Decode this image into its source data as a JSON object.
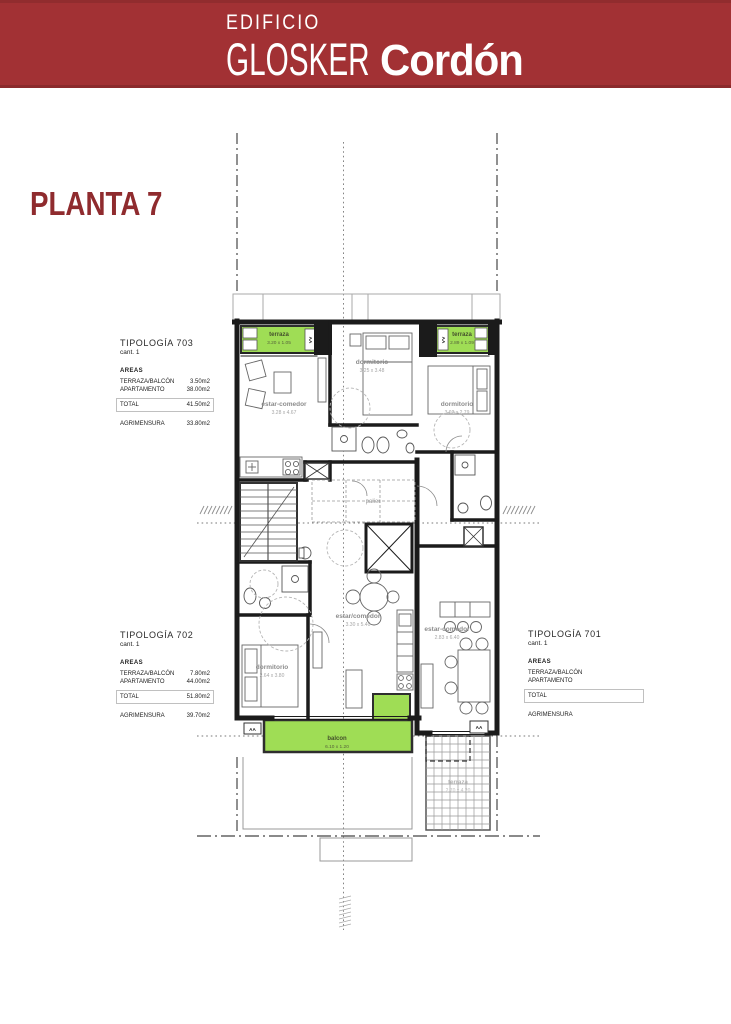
{
  "header": {
    "edificio": "EDIFICIO",
    "glosker": "GLOSKER",
    "cordon": "Cordón"
  },
  "page": {
    "title": "PLANTA 7"
  },
  "typologies": [
    {
      "title": "TIPOLOGÍA 703",
      "cant": "cant. 1",
      "areas_label": "AREAS",
      "rows": [
        {
          "label": "TERRAZA/BALCÓN",
          "value": "3.50m2"
        },
        {
          "label": "APARTAMENTO",
          "value": "38.00m2"
        }
      ],
      "total_label": "TOTAL",
      "total_value": "41.50m2",
      "agrimensura_label": "AGRIMENSURA",
      "agrimensura_value": "33.80m2"
    },
    {
      "title": "TIPOLOGÍA 702",
      "cant": "cant. 1",
      "areas_label": "AREAS",
      "rows": [
        {
          "label": "TERRAZA/BALCÓN",
          "value": "7.80m2"
        },
        {
          "label": "APARTAMENTO",
          "value": "44.00m2"
        }
      ],
      "total_label": "TOTAL",
      "total_value": "51.80m2",
      "agrimensura_label": "AGRIMENSURA",
      "agrimensura_value": "39.70m2"
    },
    {
      "title": "TIPOLOGÍA 701",
      "cant": "cant. 1",
      "areas_label": "AREAS",
      "rows": [
        {
          "label": "TERRAZA/BALCÓN",
          "value": ""
        },
        {
          "label": "APARTAMENTO",
          "value": ""
        }
      ],
      "total_label": "TOTAL",
      "total_value": "",
      "agrimensura_label": "AGRIMENSURA",
      "agrimensura_value": ""
    }
  ],
  "plan": {
    "rooms": {
      "terraza_703": {
        "name": "terraza",
        "dims": "3.20 x 1.05"
      },
      "dormitorio_703": {
        "name": "dormitorio",
        "dims": "3.25 x 3.48"
      },
      "terraza_701_top": {
        "name": "terraza",
        "dims": "2.89 x 1.09"
      },
      "estar_comedor_703": {
        "name": "estar-comedor",
        "dims": "3.28 x 4.67"
      },
      "dormitorio_701": {
        "name": "dormitorio",
        "dims": "3.02 x 2.79"
      },
      "palier": {
        "name": "palier"
      },
      "dormitorio_702": {
        "name": "dormitorio",
        "dims": "2.64 x 3.80"
      },
      "estar_comedor_702": {
        "name": "estar/comedor",
        "dims": "3.30 x 5.40"
      },
      "estar_comedor_701": {
        "name": "estar-comedor",
        "dims": "2.83 x 6.40"
      },
      "balcon_702": {
        "name": "balcon",
        "dims": "6.10 x 1.20"
      },
      "terraza_701": {
        "name": "terraza",
        "dims": "2.70 x 4.20"
      }
    },
    "markers": {
      "window_type": "AA"
    },
    "colors": {
      "banner_red": "#a23134",
      "title_red": "#8f2b2e",
      "terrace_green": "#9fdd55",
      "wall": "#1b1b1b"
    }
  }
}
